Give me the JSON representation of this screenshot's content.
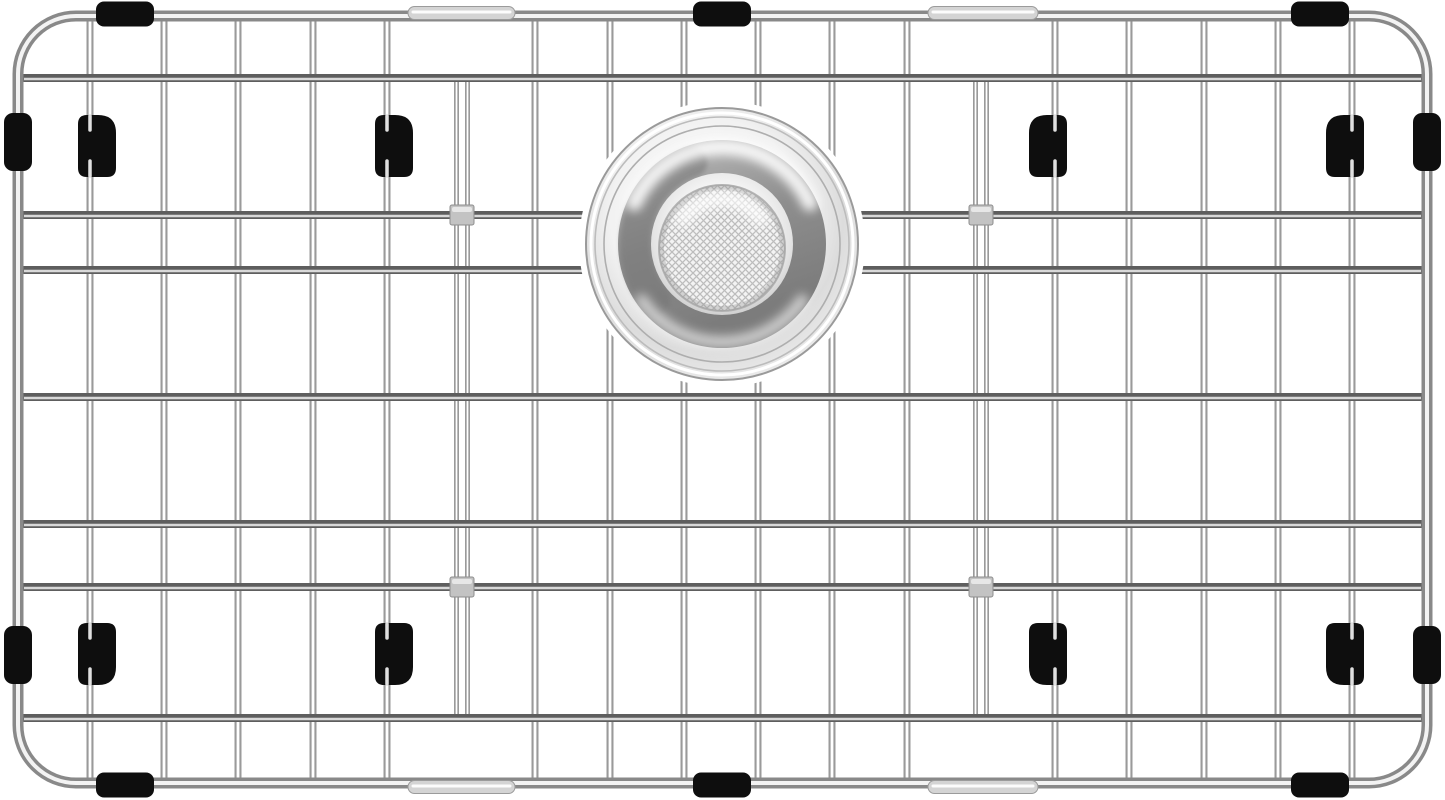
{
  "meta": {
    "title": "Stainless steel kitchen sink bottom grid with center drain strainer and black rubber feet",
    "canvas": {
      "width": 1445,
      "height": 800
    },
    "background": "#ffffff"
  },
  "colors": {
    "wire_vertical_base": "#9a9a9a",
    "wire_vertical_highlight": "#ffffff",
    "wire_horizontal_base": "#5e5e5e",
    "wire_horizontal_highlight": "#d9d9d9",
    "frame_base": "#898989",
    "frame_highlight": "#f3f3f3",
    "rubber_black": "#0e0e0e",
    "sleeve_fill": "#d4d4d4",
    "sleeve_edge": "#9b9b9b",
    "sleeve_highlight": "#fcfcfc",
    "block_fill": "#c3c3c3",
    "block_edge": "#8e8e8e",
    "block_highlight": "#ebebeb",
    "mesh_bg": "#f3f3f3",
    "mesh_line": "#bdbdbd",
    "foot_glint": "#e0e0e0",
    "body_grad": [
      "#ffffff",
      "#f2f2f2",
      "#dcdcdc",
      "#ebebeb"
    ],
    "inner_grad": [
      "#ffffff",
      "#f5f5f5",
      "#e3e3e3",
      "#cbcbcb"
    ],
    "bowl_grad": [
      "#b7b7b7",
      "#8e8e8e",
      "#7c7c7c"
    ]
  },
  "frame": {
    "x": 18,
    "y": 16,
    "right": 1427,
    "bottom": 783,
    "corner_radius": 58,
    "stroke_width": 11,
    "highlight_width": 4
  },
  "grid": {
    "vertical_wires": {
      "xs": [
        90,
        164,
        238,
        313,
        387,
        535,
        610,
        684,
        758,
        832,
        907,
        1055,
        1129,
        1204,
        1278,
        1352
      ],
      "y1": 16,
      "y2": 781,
      "base_width": 7,
      "highlight_width": 2.8
    },
    "horizontal_wires": {
      "ys": [
        78,
        215,
        270,
        397,
        524,
        587,
        718
      ],
      "x1": 22,
      "x2": 1423,
      "base_width": 8,
      "highlight_width": 2.4
    },
    "support_wires": {
      "xs": [
        462,
        981
      ],
      "y1": 79,
      "y2": 718,
      "pair_offset": 5.5,
      "base_width": 5,
      "highlight_width": 1.7
    },
    "connector_blocks": {
      "positions": [
        [
          462,
          215
        ],
        [
          981,
          215
        ],
        [
          462,
          587
        ],
        [
          981,
          587
        ]
      ],
      "width": 24,
      "height": 20
    }
  },
  "strainer": {
    "cx": 722,
    "cy": 244,
    "halo_radius": 143,
    "outer_radius": 136,
    "rim_rings": [
      {
        "r": 131,
        "color": "#ffffff",
        "w": 3
      },
      {
        "r": 127,
        "color": "#bcbcbc",
        "w": 1.6
      },
      {
        "r": 118,
        "color": "#aeaeae",
        "w": 1.6
      }
    ],
    "rim_edge_color": "#9a9a9a",
    "bowl_ring": {
      "r": 87,
      "width": 34
    },
    "dark_arc": {
      "r": 87,
      "width": 30,
      "a1": 140,
      "a2": 250,
      "color": "#767676",
      "opacity": 0.55
    },
    "inner_radius": 71,
    "sheen_top": {
      "r": 97,
      "a1": 205,
      "a2": 335,
      "width": 16,
      "color": "#ffffff",
      "opacity": 0.9
    },
    "sheen_bottom": {
      "r": 98,
      "a1": 35,
      "a2": 145,
      "width": 12,
      "color": "#fafafa",
      "opacity": 0.65
    },
    "mesh": {
      "cy": 248,
      "r": 63,
      "ring_color": "#b2b2b2",
      "edge_shade": "rgba(150,150,150,0.35)"
    }
  },
  "feet": {
    "positions": [
      [
        90,
        146
      ],
      [
        387,
        146
      ],
      [
        1055,
        146
      ],
      [
        1352,
        146
      ],
      [
        90,
        654
      ],
      [
        387,
        654
      ],
      [
        1055,
        654
      ],
      [
        1352,
        654
      ]
    ],
    "height": 62,
    "extend": 26,
    "inner": 12,
    "corner_radius": 9,
    "chamfer_radius": 18,
    "center_x": 722,
    "center_y": 400
  },
  "side_bumpers": {
    "left_x": 18,
    "right_x": 1427,
    "cys": [
      142,
      655
    ],
    "width": 28,
    "height": 58,
    "radius": 9
  },
  "cap_bumpers": {
    "cxs": [
      125,
      722,
      1320
    ],
    "top_cy": 14,
    "bottom_cy": 785,
    "width": 58,
    "height": 25,
    "radius": 8
  },
  "frame_sleeves": {
    "spans": [
      [
        408,
        515
      ],
      [
        928,
        1038
      ]
    ],
    "top_cy": 13,
    "bottom_cy": 787,
    "height": 13
  }
}
